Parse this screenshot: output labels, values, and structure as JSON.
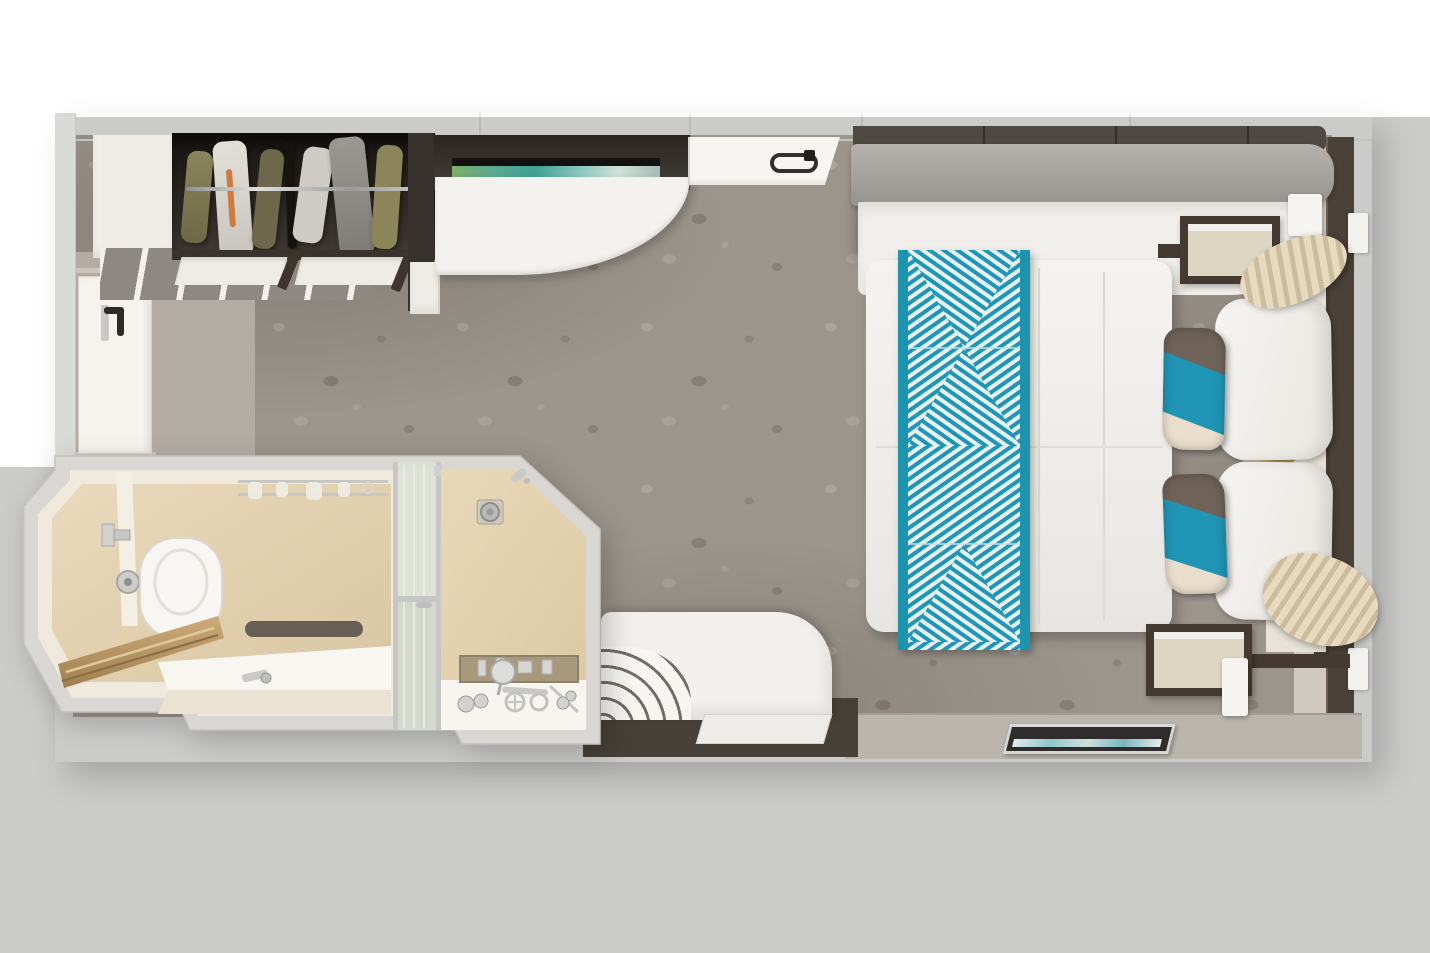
{
  "meta": {
    "title": "Cruise ship stateroom — top-down cutaway floor plan rendering",
    "canvas": {
      "width": 1430,
      "height": 953
    },
    "view": "overhead dollhouse view, no visible text in image"
  },
  "palette": {
    "bg": "#cbcbca",
    "bgWhite": "#ffffff",
    "wallLight": "#dcdcda",
    "wallDark": "#4a4138",
    "carpet": "#9c958c",
    "vinyl": "#b2aca5",
    "vinyl2": "#cfc9bf",
    "ledge": "#bab5ad",
    "white": "#f4f2ee",
    "cream": "#f0e9dd",
    "marble": "#e3d0ae",
    "teal": "#2095b5",
    "tealBar": "#1d93ad",
    "stripeLight": "#e6f2f4",
    "taupePillow": "#6f6257",
    "creamPillow": "#eadfcd",
    "beigeFace": "#ddd6c3",
    "frameBrown": "#443a31",
    "curtain": "#d9cab0",
    "chrome": "#c6c6c4",
    "gold": "#b59a55",
    "wood": "#b3925f",
    "sofaGray": "#a7a3a0",
    "sofaBack": "#4e4943",
    "artGreens": [
      "#7fae69",
      "#5ba98e",
      "#3f9f96",
      "#85c4bb"
    ]
  },
  "scene": {
    "rooms": [
      {
        "name": "cabin",
        "floor": "patterned gray-taupe carpet"
      },
      {
        "name": "bathroom",
        "floor": "beige marble, protrudes bottom-left"
      }
    ],
    "objects": [
      {
        "name": "entry-door",
        "note": "white door with dark lever handle, left wall"
      },
      {
        "name": "wardrobe-closet",
        "note": "dark open closet, chrome rail, hanging clothes (olive, white with orange stripe, gray)"
      },
      {
        "name": "luggage-shelf-slats",
        "note": "white angled slats beside door"
      },
      {
        "name": "desk-vanity",
        "note": "white quarter-round desk under dark overhead cabinet with landscape artwork strip"
      },
      {
        "name": "pullman-panel",
        "note": "white wall panel with loop handle"
      },
      {
        "name": "berth-sofa",
        "note": "long gray cushion bench with white base along top wall"
      },
      {
        "name": "bed",
        "note": "double bed, white duvet, teal diamond-pattern runner, 2 white pillows, 2 teal/taupe/cream accent pillows"
      },
      {
        "name": "nightstand",
        "count": 2,
        "note": "beige face, dark brown frame"
      },
      {
        "name": "wall-sconce",
        "count": 2
      },
      {
        "name": "curtains",
        "note": "beige tiebacks at window wall, head and foot of bed"
      },
      {
        "name": "window-wall",
        "note": "dark brown frame, right edge"
      },
      {
        "name": "sofa",
        "note": "white sofa with rolled towels on left arm, bottom center"
      },
      {
        "name": "floor-mat",
        "note": "white mat in front of sofa"
      },
      {
        "name": "framed-picture",
        "note": "silver frame with teal artwork on bottom ledge"
      },
      {
        "name": "toilet"
      },
      {
        "name": "toilet-paper-holder"
      },
      {
        "name": "towel-rack",
        "note": "chrome, with towels, bathroom top wall"
      },
      {
        "name": "vanity-counter",
        "note": "white counter with chrome faucet and folded dark towel"
      },
      {
        "name": "wooden-bench",
        "note": "angled oak ledge, bathroom lower-left"
      },
      {
        "name": "shower-enclosure",
        "note": "chamfered corner, frosted glass door with chrome frame"
      },
      {
        "name": "shower-head"
      },
      {
        "name": "floor-drain"
      },
      {
        "name": "toiletry-niche",
        "note": "recessed shelf with chrome bottles"
      },
      {
        "name": "shower-accessories",
        "note": "chrome bottles, cross-handle faucet, magnifying mirror on white curb"
      }
    ]
  }
}
